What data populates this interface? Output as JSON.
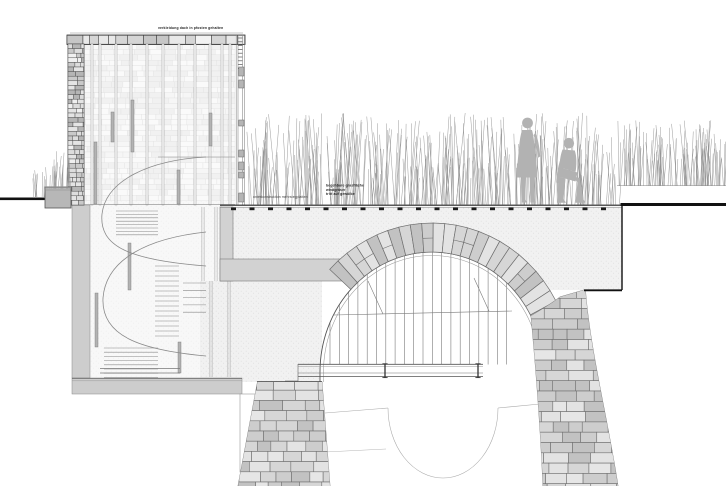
{
  "drawing": {
    "annotations": {
      "roof": "verkleidung dach in pfosten gehalten",
      "deck_lines": [
        "begehbare grasfläche",
        "windgräser",
        "tritt auf gewölbe"
      ],
      "underside": "unterkonstruktion mehrstegplatten"
    },
    "colors": {
      "black": "#111111",
      "outline": "#555555",
      "joint": "#6f6f6f",
      "concrete": "#d2d2d2",
      "figure": "#b2b2b2",
      "grass": "#909090",
      "stipple_bg": "#f1f1f1",
      "stone_light": "#e6e6e6",
      "stone_fills": [
        "#c2c2c2",
        "#cdcdcd",
        "#d6d6d6",
        "#e3e3e3"
      ],
      "wall_fills": [
        "#c9c9c9",
        "#e4e4e4",
        "#b5b5b5",
        "#dddddd",
        "#f0f0f0"
      ]
    },
    "figures": [
      "standing person on grass deck",
      "crouching person on grass deck"
    ]
  }
}
